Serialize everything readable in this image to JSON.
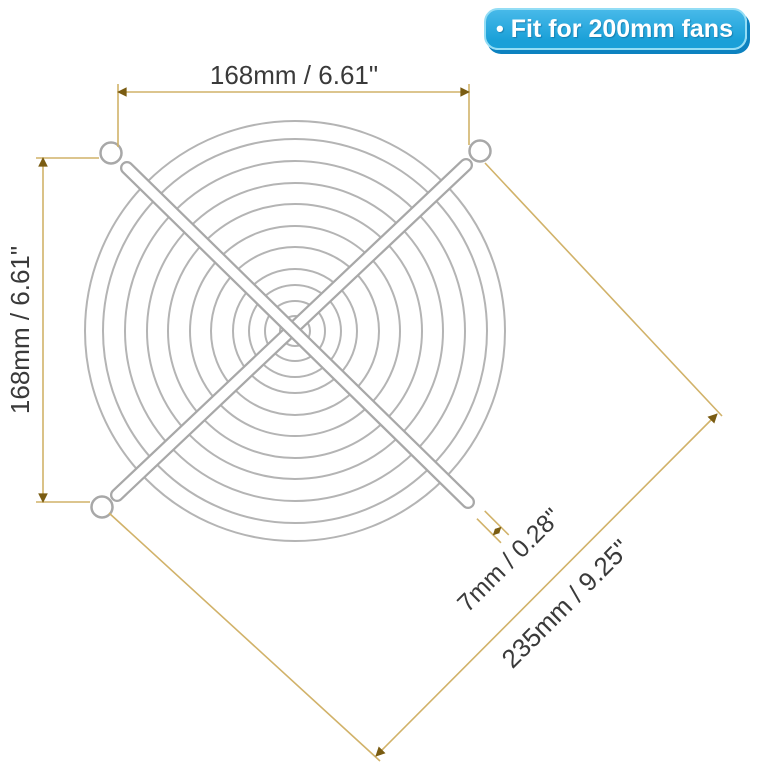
{
  "badge": {
    "bullet": "•",
    "label": "Fit for 200mm fans",
    "fill_color": "#29a9de",
    "border_color": "#93ddf5",
    "shadow_color": "#0d82c0",
    "text_color": "#ffffff"
  },
  "dimensions": {
    "width": "168mm / 6.61\"",
    "height": "168mm / 6.61\"",
    "diagonal": "235mm / 9.25\"",
    "wire_thickness": "7mm / 0.28\"",
    "line_color": "#d1b269",
    "arrow_color": "#7a5c12",
    "text_color": "#3a3a3a"
  },
  "grill": {
    "wire_color": "#b4b4b4",
    "arm_color": "#a8a8a8"
  }
}
